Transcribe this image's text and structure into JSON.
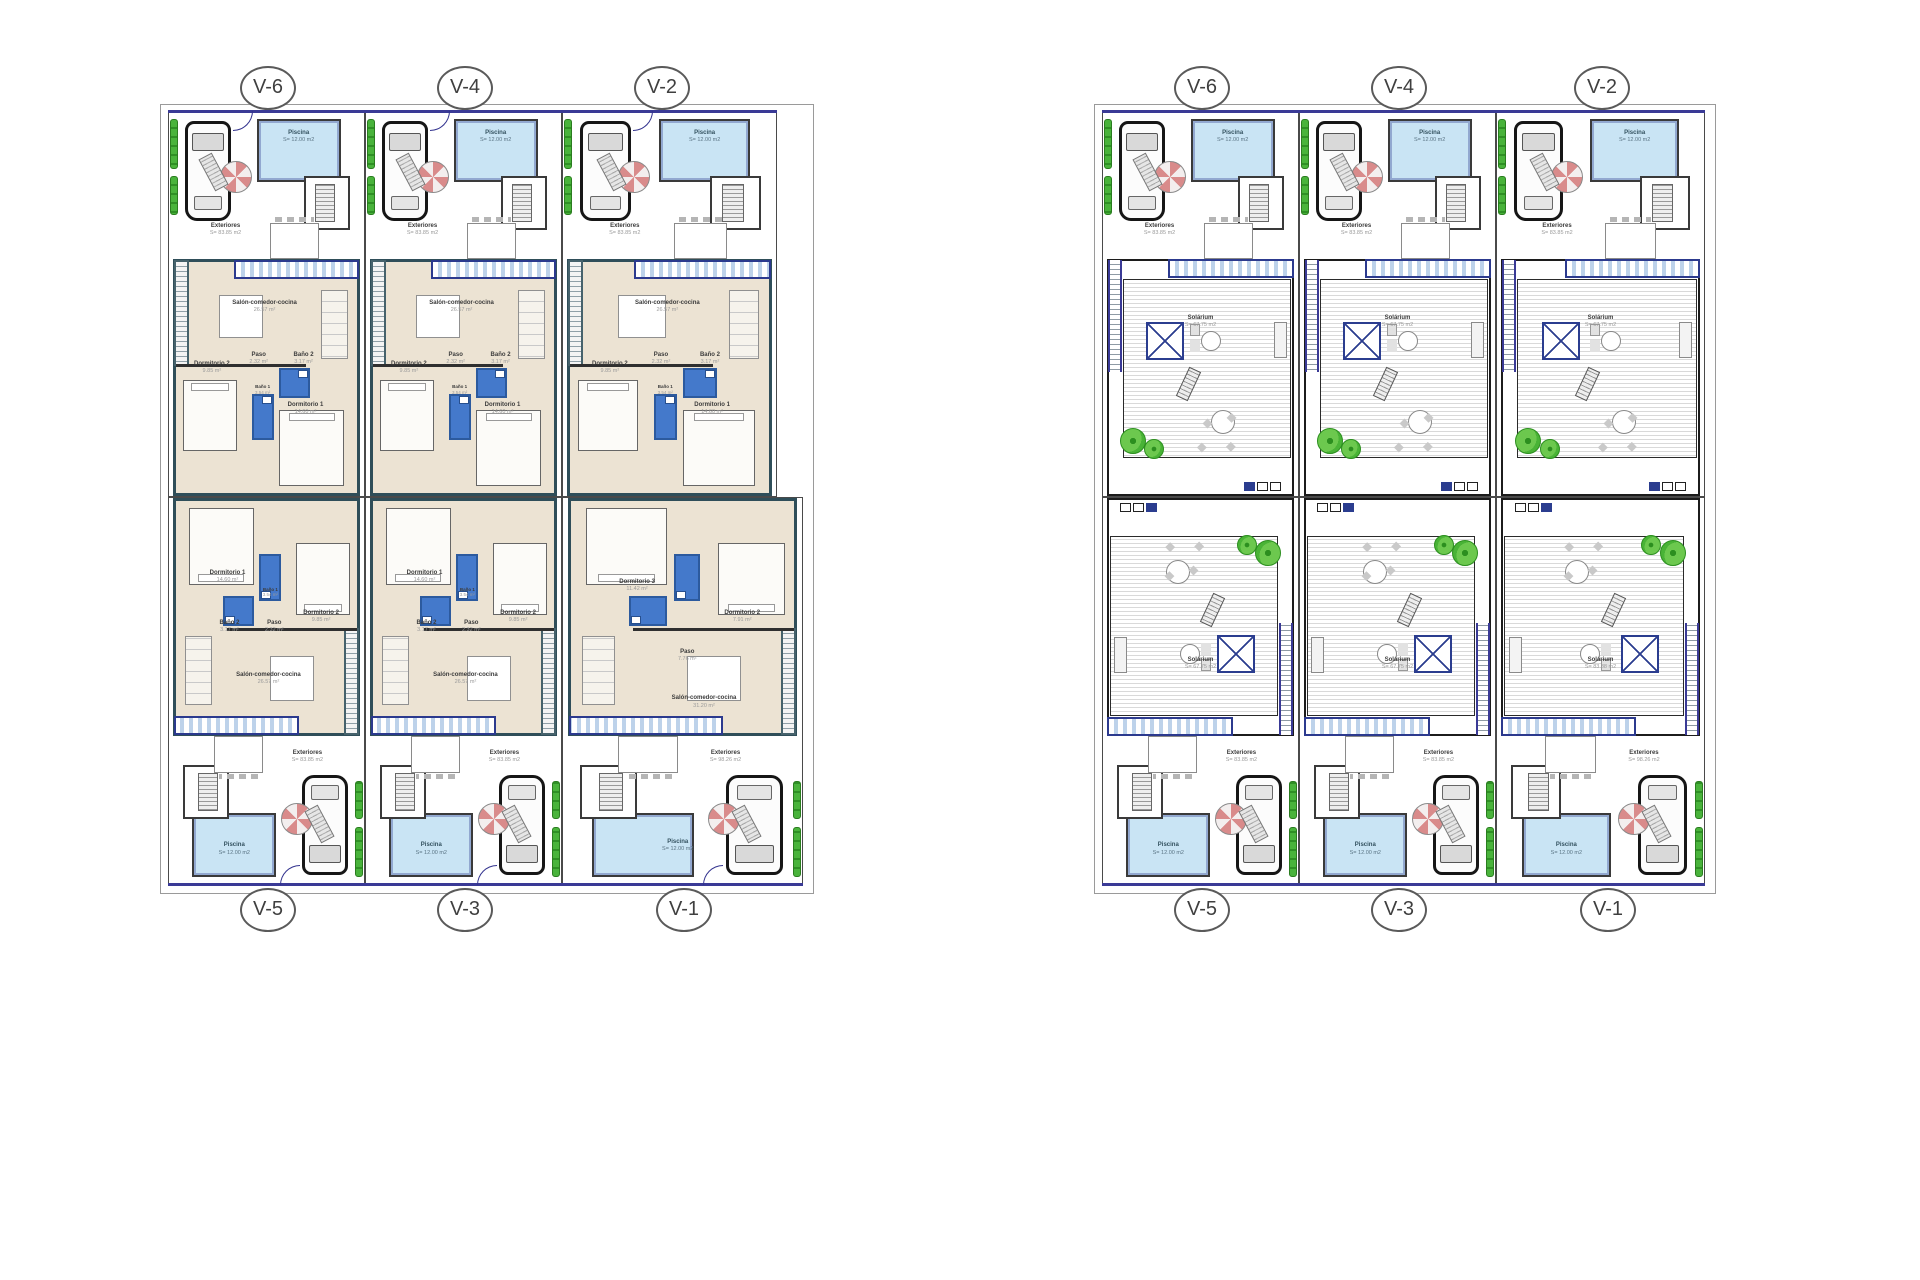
{
  "sheets": [
    {
      "id": "ground-floor-plan",
      "circles_top": [
        "V-6",
        "V-4",
        "V-2"
      ],
      "circles_bottom": [
        "V-5",
        "V-3",
        "V-1"
      ],
      "units": [
        {
          "tag": "V-6",
          "exteriores": {
            "name": "Exteriores",
            "area": "S= 83.85 m2"
          },
          "piscina": {
            "name": "Piscina",
            "area": "S= 12.00 m2"
          },
          "salon": {
            "name": "Salón-comedor-cocina",
            "area": "26.57 m²"
          },
          "paso": {
            "name": "Paso",
            "area": "2.32 m²"
          },
          "bano2": {
            "name": "Baño 2",
            "area": "3.17 m²"
          },
          "dorm2": {
            "name": "Dormitorio 2",
            "area": "9.85 m²"
          },
          "bano1": {
            "name": "Baño 1",
            "area": "3.54 m²"
          },
          "dorm1": {
            "name": "Dormitorio 1",
            "area": "14.60 m²"
          }
        },
        {
          "tag": "V-4",
          "exteriores": {
            "name": "Exteriores",
            "area": "S= 83.85 m2"
          },
          "piscina": {
            "name": "Piscina",
            "area": "S= 12.00 m2"
          },
          "salon": {
            "name": "Salón-comedor-cocina",
            "area": "26.57 m²"
          },
          "paso": {
            "name": "Paso",
            "area": "2.32 m²"
          },
          "bano2": {
            "name": "Baño 2",
            "area": "3.17 m²"
          },
          "dorm2": {
            "name": "Dormitorio 2",
            "area": "9.85 m²"
          },
          "bano1": {
            "name": "Baño 1",
            "area": "3.54 m²"
          },
          "dorm1": {
            "name": "Dormitorio 1",
            "area": "14.60 m²"
          }
        },
        {
          "tag": "V-2",
          "exteriores": {
            "name": "Exteriores",
            "area": "S= 83.85 m2"
          },
          "piscina": {
            "name": "Piscina",
            "area": "S= 12.00 m2"
          },
          "salon": {
            "name": "Salón-comedor-cocina",
            "area": "26.57 m²"
          },
          "paso": {
            "name": "Paso",
            "area": "2.32 m²"
          },
          "bano2": {
            "name": "Baño 2",
            "area": "3.17 m²"
          },
          "dorm2": {
            "name": "Dormitorio 2",
            "area": "9.85 m²"
          },
          "bano1": {
            "name": "Baño 1",
            "area": "3.54 m²"
          },
          "dorm1": {
            "name": "Dormitorio 1",
            "area": "14.60 m²"
          }
        },
        {
          "tag": "V-5",
          "exteriores": {
            "name": "Exteriores",
            "area": "S= 83.85 m2"
          },
          "piscina": {
            "name": "Piscina",
            "area": "S= 12.00 m2"
          },
          "salon": {
            "name": "Salón-comedor-cocina",
            "area": "26.57 m²"
          },
          "paso": {
            "name": "Paso",
            "area": "2.32 m²"
          },
          "bano2": {
            "name": "Baño 2",
            "area": "3.17 m²"
          },
          "dorm2": {
            "name": "Dormitorio 2",
            "area": "9.85 m²"
          },
          "bano1": {
            "name": "Baño 1",
            "area": "3.54 m²"
          },
          "dorm1": {
            "name": "Dormitorio 1",
            "area": "14.60 m²"
          }
        },
        {
          "tag": "V-3",
          "exteriores": {
            "name": "Exteriores",
            "area": "S= 83.85 m2"
          },
          "piscina": {
            "name": "Piscina",
            "area": "S= 12.00 m2"
          },
          "salon": {
            "name": "Salón-comedor-cocina",
            "area": "26.57 m²"
          },
          "paso": {
            "name": "Paso",
            "area": "2.32 m²"
          },
          "bano2": {
            "name": "Baño 2",
            "area": "3.17 m²"
          },
          "dorm2": {
            "name": "Dormitorio 2",
            "area": "9.85 m²"
          },
          "bano1": {
            "name": "Baño 1",
            "area": "3.54 m²"
          },
          "dorm1": {
            "name": "Dormitorio 1",
            "area": "14.60 m²"
          }
        },
        {
          "tag": "V-1",
          "exteriores": {
            "name": "Exteriores",
            "area": "S= 98.26 m2"
          },
          "piscina": {
            "name": "Piscina",
            "area": "S= 12.00 m2"
          },
          "salon": {
            "name": "Salón-comedor-cocina",
            "area": "31.20 m²"
          },
          "paso": {
            "name": "Paso",
            "area": "7.76 m²"
          },
          "dorm3": {
            "name": "Dormitorio 3",
            "area": "11.42 m²"
          },
          "dorm2": {
            "name": "Dormitorio 2",
            "area": "7.91 m²"
          }
        }
      ]
    },
    {
      "id": "roof-solarium-plan",
      "circles_top": [
        "V-6",
        "V-4",
        "V-2"
      ],
      "circles_bottom": [
        "V-5",
        "V-3",
        "V-1"
      ],
      "units": [
        {
          "tag": "V-6",
          "exteriores": {
            "name": "Exteriores",
            "area": "S= 83.85 m2"
          },
          "piscina": {
            "name": "Piscina",
            "area": "S= 12.00 m2"
          },
          "solarium": {
            "name": "Solárium",
            "area": "S= 67.75 m2"
          }
        },
        {
          "tag": "V-4",
          "exteriores": {
            "name": "Exteriores",
            "area": "S= 83.85 m2"
          },
          "piscina": {
            "name": "Piscina",
            "area": "S= 12.00 m2"
          },
          "solarium": {
            "name": "Solárium",
            "area": "S= 67.75 m2"
          }
        },
        {
          "tag": "V-2",
          "exteriores": {
            "name": "Exteriores",
            "area": "S= 83.85 m2"
          },
          "piscina": {
            "name": "Piscina",
            "area": "S= 12.00 m2"
          },
          "solarium": {
            "name": "Solárium",
            "area": "S= 67.75 m2"
          }
        },
        {
          "tag": "V-5",
          "exteriores": {
            "name": "Exteriores",
            "area": "S= 83.85 m2"
          },
          "piscina": {
            "name": "Piscina",
            "area": "S= 12.00 m2"
          },
          "solarium": {
            "name": "Solárium",
            "area": "S= 67.75 m2"
          }
        },
        {
          "tag": "V-3",
          "exteriores": {
            "name": "Exteriores",
            "area": "S= 83.85 m2"
          },
          "piscina": {
            "name": "Piscina",
            "area": "S= 12.00 m2"
          },
          "solarium": {
            "name": "Solárium",
            "area": "S= 67.75 m2"
          }
        },
        {
          "tag": "V-1",
          "exteriores": {
            "name": "Exteriores",
            "area": "S= 98.26 m2"
          },
          "piscina": {
            "name": "Piscina",
            "area": "S= 12.00 m2"
          },
          "solarium": {
            "name": "Solárium",
            "area": "S= 83.88 m2"
          }
        }
      ]
    }
  ]
}
